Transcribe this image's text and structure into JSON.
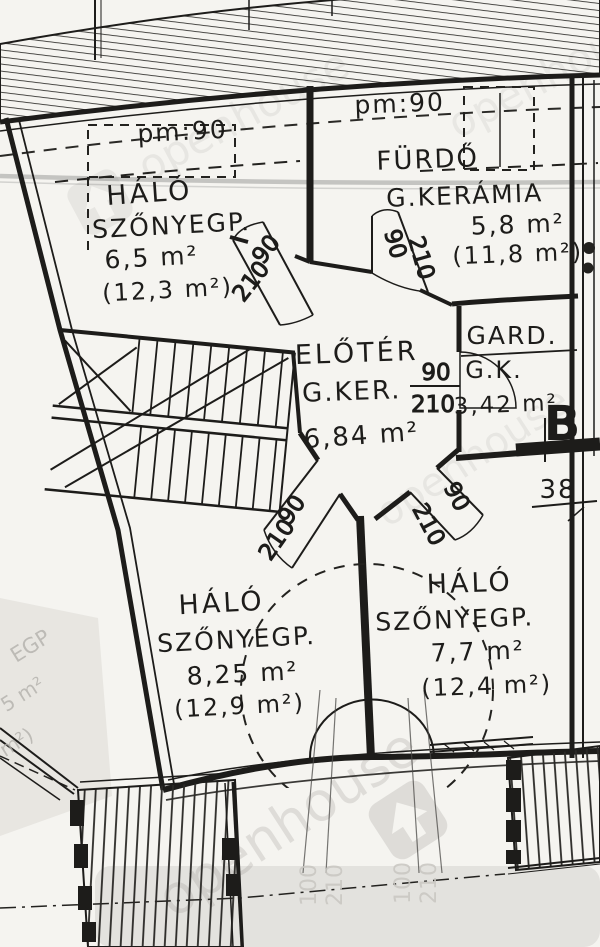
{
  "colors": {
    "paper": "#f5f4f0",
    "ink": "#1d1c1a",
    "smudge": "#6a6a6a",
    "watermark": "#8e8c88",
    "ghost": "#b3b1ac"
  },
  "watermark": {
    "text": "openhouse"
  },
  "labels": {
    "pm90_left": "pm:90",
    "pm90_right": "pm:90",
    "section_b": "B",
    "dim_38": "38"
  },
  "rooms": {
    "halo_nw": {
      "name": "HÁLÓ",
      "floor": "SZŐNYEGP.",
      "area": "6,5 m²",
      "area_gross": "(12,3 m²)"
    },
    "furdo": {
      "name": "FÜRDŐ",
      "floor": "G.KERÁMIA",
      "area": "5,8 m²",
      "area_gross": "(11,8 m²)"
    },
    "eloter": {
      "name": "ELŐTÉR",
      "floor": "G.KER.",
      "area": "6,84 m²"
    },
    "gard": {
      "name": "GARD.",
      "floor": "G.K.",
      "area": "3,42 m²"
    },
    "halo_sw": {
      "name": "HÁLÓ",
      "floor": "SZŐNYEGP.",
      "area": "8,25 m²",
      "area_gross": "(12,9 m²)"
    },
    "halo_se": {
      "name": "HÁLÓ",
      "floor": "SZŐNYEGP.",
      "area": "7,7 m²",
      "area_gross": "(12,4 m²)"
    }
  },
  "doors": {
    "nw": {
      "width": "90",
      "height": "210"
    },
    "furdo": {
      "width": "90",
      "height": "210"
    },
    "gard": {
      "width": "90",
      "height": "210"
    },
    "sw": {
      "width": "90",
      "height": "210"
    },
    "se": {
      "width": "90",
      "height": "210"
    }
  },
  "ghost": {
    "left_fragments": [
      "EGP",
      "5 m²",
      "m²)"
    ],
    "bottom_doors": [
      {
        "width": "100",
        "height": "210"
      },
      {
        "width": "100",
        "height": "210"
      }
    ]
  }
}
